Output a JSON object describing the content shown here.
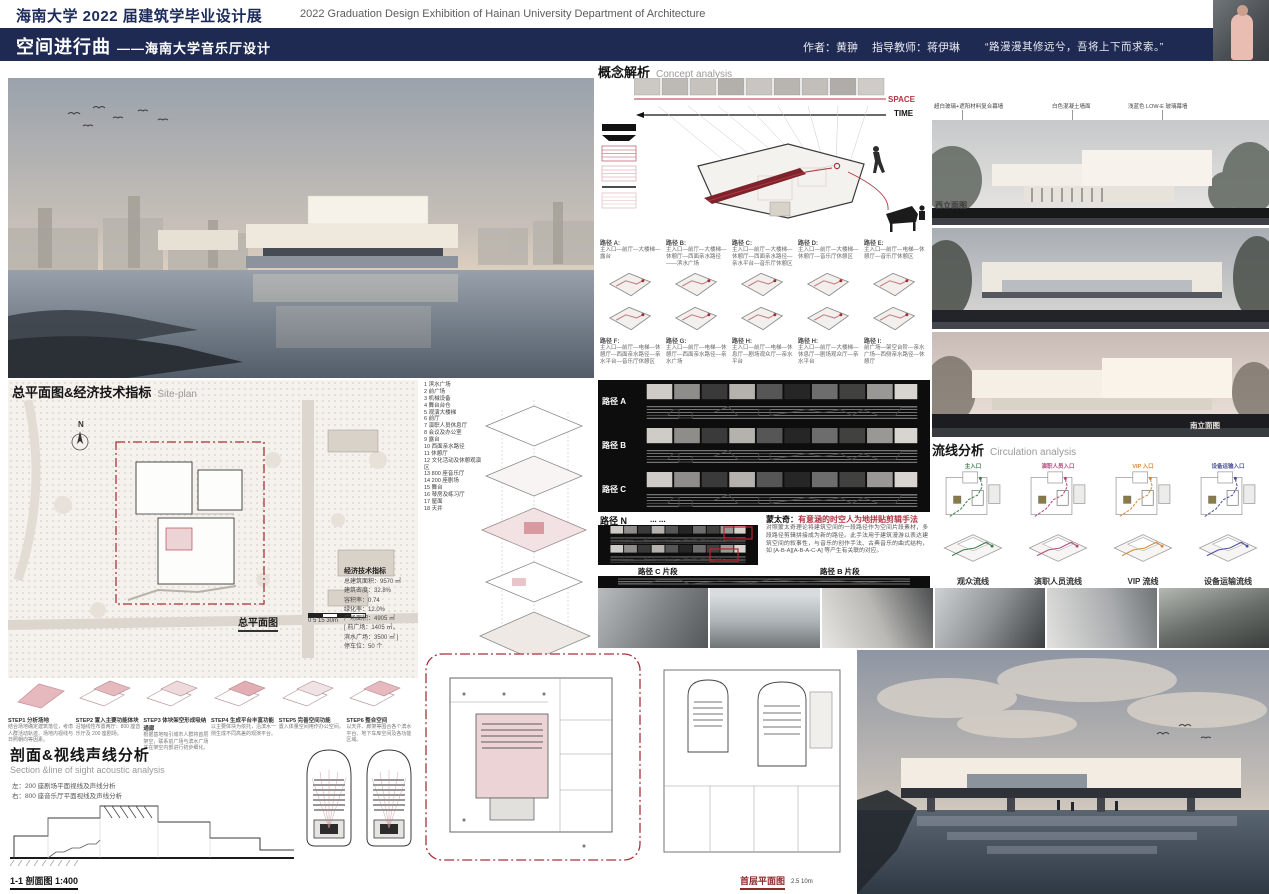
{
  "colors": {
    "navy": "#1f2a52",
    "title_blue": "#1c2b5a",
    "accent_red": "#9e3038",
    "pink_massing": "#e6bcc1",
    "audience_green": "#3f7d4e",
    "staff_magenta": "#b34a7a",
    "vip_orange": "#d6893b",
    "equipment_indigo": "#4c4f9c"
  },
  "icons": {
    "north_arrow": "compass-needle",
    "birds": "bird-flock-strokes"
  },
  "header": {
    "cn_title": "海南大学 2022 届建筑学毕业设计展",
    "en_title": "2022 Graduation Design Exhibition of Hainan University Department of Architecture"
  },
  "titlebar": {
    "title": "空间进行曲",
    "subtitle": "——海南大学音乐厅设计",
    "author": "作者：黄翀",
    "advisor": "指导教师：蒋伊琳",
    "quote": "“路漫漫其修远兮，吾将上下而求索。”"
  },
  "concept": {
    "title_cn": "概念解析",
    "title_en": "Concept analysis",
    "space_label": "SPACE",
    "time_label": "TIME",
    "paths_row1": [
      {
        "label": "路径 A:",
        "desc": "主入口—前厅—大楼梯—露台"
      },
      {
        "label": "路径 B:",
        "desc": "主入口—前厅—大楼梯—休憩厅—西面亲水路径——滨水广场"
      },
      {
        "label": "路径 C:",
        "desc": "主入口—前厅—大楼梯—休憩厅—西面亲水路径—亲水平台—音乐厅休憩区"
      },
      {
        "label": "路径 D:",
        "desc": "主入口—前厅—大楼梯—休憩厅—音乐厅休憩区"
      },
      {
        "label": "路径 E:",
        "desc": "主入口—前厅—电梯—休憩厅—音乐厅休憩区"
      }
    ],
    "paths_row2": [
      {
        "label": "路径 F:",
        "desc": "主入口—前厅—电梯—休憩厅—西面亲水路径—亲水平台—音乐厅休憩区"
      },
      {
        "label": "路径 G:",
        "desc": "主入口—前厅—电梯—休憩厅—西面亲水路径—亲水广场"
      },
      {
        "label": "路径 H:",
        "desc": "主入口—前厅—电梯—休息厅—剧场观众厅—亲水平台"
      },
      {
        "label": "路径 H:",
        "desc": "主入口—前厅—大楼梯—休息厅—剧场观众厅—亲水平台"
      },
      {
        "label": "路径 I:",
        "desc": "前广场—架空台阶—亲水广场—西侧亲水路径—休憩厅"
      }
    ],
    "strip_rows": [
      "路径 A",
      "路径 B",
      "路径 C"
    ],
    "path_n": {
      "label": "路径 N",
      "dots": "... ...",
      "fragment_c": "路径 C 片段",
      "fragment_b": "路径 B 片段"
    },
    "montage": {
      "title": "蒙太奇：",
      "subtitle": "有意涵的时空人为地拼贴剪辑手法",
      "body": "对照蒙太奇理论将建筑空间的一段路径作为空间片段素材，多段路径剪辑拼接成为新的路径。此手法用于建筑漫游以表达建筑空间的叙事性，与音乐的创作手法、古典音乐的曲式结构，如 [A-B-A][A-B-A-C-A] 等产生有关联的对应。"
    }
  },
  "siteplan": {
    "title_cn": "总平面图&经济技术指标",
    "title_en": "Site-plan",
    "north_label": "N",
    "plan_label": "总平面图",
    "plan_scale": "0  5  15  30m",
    "legend": [
      "1 滨水广场",
      "2 前广场",
      "3 机械设备",
      "4 舞台台仓",
      "5 观演大楼梯",
      "6 前厅",
      "7 演职人员休息厅",
      "8 会议及办公室",
      "9 露台",
      "10 西面亲水路径",
      "11 休憩厅",
      "12 文化活动及休憩观演区",
      "13 800 座音乐厅",
      "14 200 座剧场",
      "15 舞台",
      "16 琴房及练习厅",
      "17 屋面",
      "18 天井"
    ],
    "indicators_title": "经济技术指标",
    "indicators": [
      "总建筑面积：9570 ㎡",
      "建筑密度：32.8%",
      "容积率：0.74",
      "绿化率：12.0%",
      "广场面积：4905 ㎡",
      "[ 前广场：1405 ㎡，",
      "滨水广场：3500 ㎡ ]",
      "停车位：50 个"
    ]
  },
  "elevations": {
    "annotation_1": "超白玻璃+遮阳材料复合幕墙",
    "annotation_2": "白色混凝土墙面",
    "annotation_3": "浅蓝色 LOW-E 玻璃幕墙",
    "west_label": "西立面图",
    "south_label": "南立面图"
  },
  "circulation": {
    "title_cn": "流线分析",
    "title_en": "Circulation analysis",
    "columns": [
      {
        "label": "观众流线",
        "entrance": "主入口"
      },
      {
        "label": "演职人员流线",
        "entrance": "演职人员入口"
      },
      {
        "label": "VIP 流线",
        "entrance": "VIP 入口"
      },
      {
        "label": "设备运输流线",
        "entrance": "设备运输入口"
      }
    ]
  },
  "steps": [
    {
      "label": "STEP1 分析场地",
      "desc": "结合场地确定建筑落位，考虑人群活动轨迹、场地内视线与日照朝向等因素。"
    },
    {
      "label": "STEP2 置入主要功能体块",
      "desc": "沿轴线性布置两厅：800 座音乐厅及 200 座剧场。"
    },
    {
      "label": "STEP3 体块架空形成吸纳通廊",
      "desc": "根据基地吸引城市人群将首层架空，联系前广场与滨水广场并在架空内部进行初步细化。"
    },
    {
      "label": "STEP4 生成平台丰富功能",
      "desc": "以主要体块为依托，沿滨水一侧生成不同高差的观演平台。"
    },
    {
      "label": "STEP5 完善空间功能",
      "desc": "置入体量空间用作办公空间。"
    },
    {
      "label": "STEP6 整合空间",
      "desc": "以天井、廊架等围合各个滨水平台、地下车库空间及各功能区域。"
    }
  ],
  "section_analysis": {
    "title_cn": "剖面&视线声线分析",
    "title_en": "Section &line of sight acoustic analysis",
    "note_left": "左：200 座剧场平面视线及声线分析",
    "note_right": "右：800 座音乐厅平面视线及声线分析",
    "section_label": "1-1 剖面图 1:400"
  },
  "plans": {
    "first_floor_label": "首层平面图",
    "first_floor_scale": "2.5        10m",
    "second_floor_label": "二层平面图",
    "second_floor_scale": "2.5        10m"
  }
}
